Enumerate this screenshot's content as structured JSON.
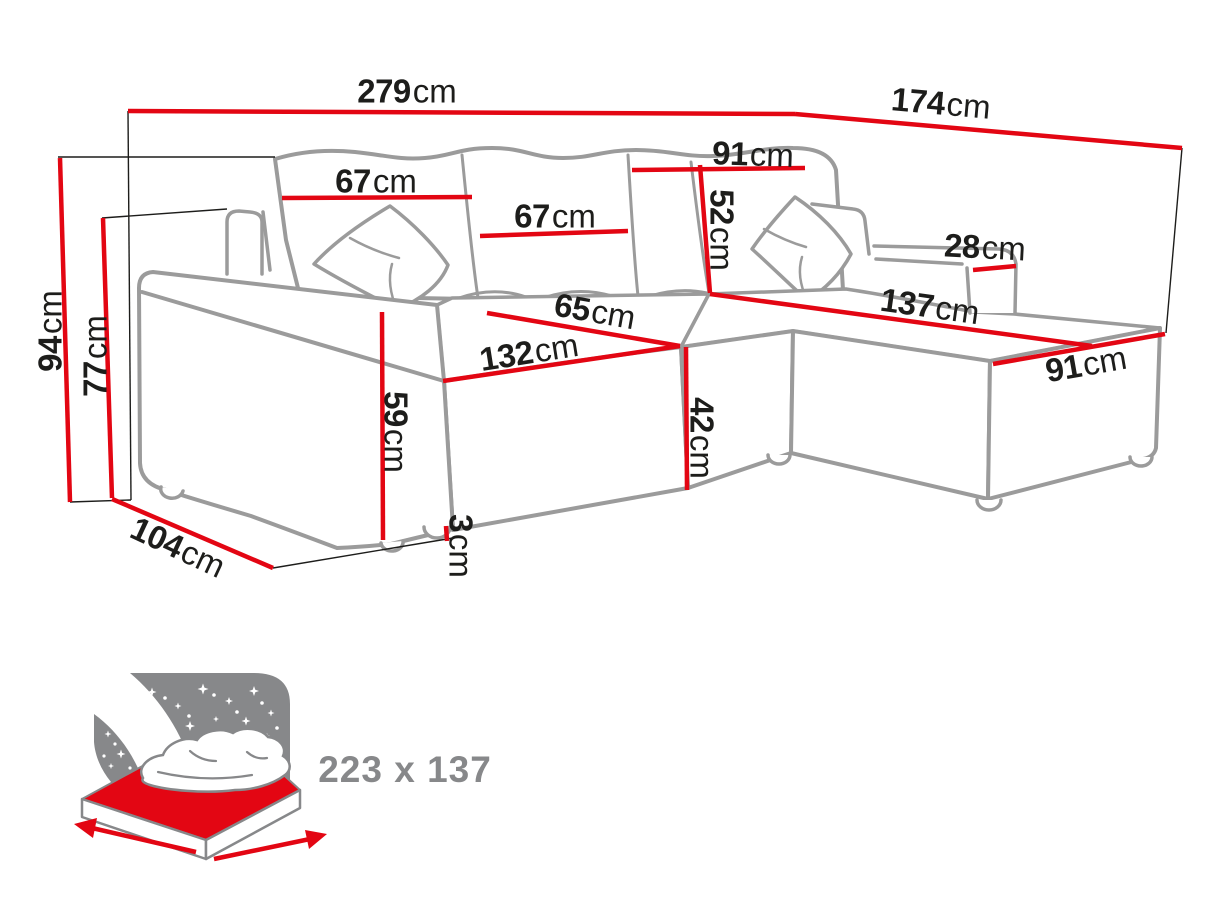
{
  "diagram_type": "corner-sofa dimension drawing",
  "colors": {
    "dimension_red": "#e30613",
    "sketch_gray": "#9b9b9b",
    "construction_black": "#1d1d1b",
    "icon_gray": "#87888a",
    "background": "#ffffff"
  },
  "dimensions": [
    {
      "name": "overall-width",
      "value": "279",
      "unit": "cm"
    },
    {
      "name": "overall-depth",
      "value": "174",
      "unit": "cm"
    },
    {
      "name": "corner-backrest-width",
      "value": "91",
      "unit": "cm"
    },
    {
      "name": "left-back-cushion-width",
      "value": "67",
      "unit": "cm"
    },
    {
      "name": "mid-back-cushion-width",
      "value": "67",
      "unit": "cm"
    },
    {
      "name": "backrest-height",
      "value": "52",
      "unit": "cm"
    },
    {
      "name": "chaise-armrest-width",
      "value": "28",
      "unit": "cm"
    },
    {
      "name": "chaise-seat-length",
      "value": "137",
      "unit": "cm"
    },
    {
      "name": "chaise-width",
      "value": "91",
      "unit": "cm"
    },
    {
      "name": "seat-depth",
      "value": "65",
      "unit": "cm"
    },
    {
      "name": "seat-front-width",
      "value": "132",
      "unit": "cm"
    },
    {
      "name": "seat-height",
      "value": "42",
      "unit": "cm"
    },
    {
      "name": "armrest-front-height",
      "value": "59",
      "unit": "cm"
    },
    {
      "name": "foot-height",
      "value": "3",
      "unit": "cm"
    },
    {
      "name": "overall-height",
      "value": "94",
      "unit": "cm"
    },
    {
      "name": "back-height",
      "value": "77",
      "unit": "cm"
    },
    {
      "name": "side-depth",
      "value": "104",
      "unit": "cm"
    }
  ],
  "sleeping_area": {
    "value": "223 x 137",
    "icon": "sleep-function-bed-icon"
  }
}
